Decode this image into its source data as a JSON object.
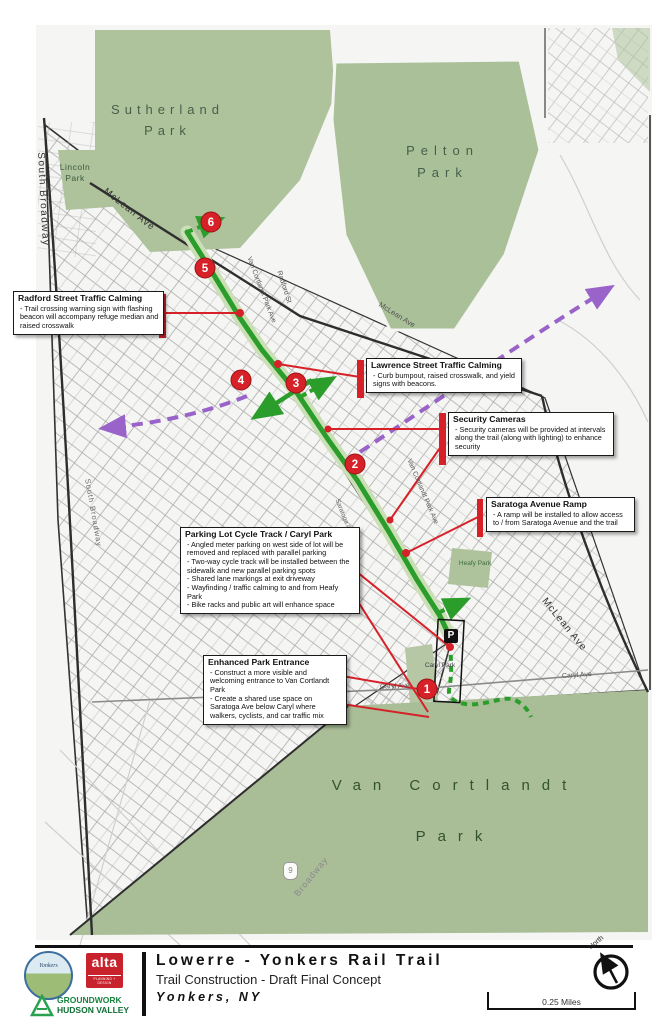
{
  "map": {
    "parks": [
      {
        "label": "Sutherland Park"
      },
      {
        "label": "Pelton Park"
      },
      {
        "label": "Lincoln Park"
      },
      {
        "label": "Van Cortlandt Park"
      },
      {
        "label": "Heafy Park"
      },
      {
        "label": "Caryl Park"
      }
    ],
    "streets": [
      {
        "label": "South Broadway"
      },
      {
        "label": "South Broadway"
      },
      {
        "label": "McLean Ave"
      },
      {
        "label": "McLean Ave"
      },
      {
        "label": "McLean Ave"
      },
      {
        "label": "Radford St"
      },
      {
        "label": "Radford St"
      },
      {
        "label": "Van Cortlandt Park Ave"
      },
      {
        "label": "Van Cortlandt Park Ave"
      },
      {
        "label": "Saratoga Ave"
      },
      {
        "label": "Caryl Ave"
      },
      {
        "label": "Caryl Ave"
      },
      {
        "label": "Broadway"
      }
    ],
    "route_shield": "9",
    "parking_label": "P",
    "markers": [
      {
        "n": "1"
      },
      {
        "n": "2"
      },
      {
        "n": "3"
      },
      {
        "n": "4"
      },
      {
        "n": "5"
      },
      {
        "n": "6"
      }
    ],
    "callouts": [
      {
        "title": "Radford Street Traffic Calming",
        "body": [
          "- Trail crossing warning sign with flashing beacon will accompany refuge median and raised crosswalk"
        ]
      },
      {
        "title": "Lawrence Street Traffic Calming",
        "body": [
          "- Curb bumpout, raised crosswalk, and yield signs with beacons."
        ]
      },
      {
        "title": "Security Cameras",
        "body": [
          "- Security cameras will be provided at intervals along the trail (along with lighting) to enhance security"
        ]
      },
      {
        "title": "Saratoga Avenue Ramp",
        "body": [
          "- A ramp will be installed to allow access to / from Saratoga Avenue and the trail"
        ]
      },
      {
        "title": "Parking Lot Cycle Track / Caryl Park",
        "body": [
          "- Angled meter parking on west side of lot will be removed and replaced with parallel parking",
          "- Two-way cycle track will be installed between the sidewalk and new parallel parking spots",
          "- Shared lane markings at exit driveway",
          "- Wayfinding / traffic calming to and from Heafy Park",
          "- Bike racks and public art will enhance space"
        ]
      },
      {
        "title": "Enhanced Park Entrance",
        "body": [
          "- Construct a more visible and welcoming entrance to Van Cortlandt Park",
          "- Create a shared use space on Saratoga Ave below Caryl where walkers, cyclists, and car traffic mix"
        ]
      }
    ]
  },
  "footer": {
    "title": "Lowerre - Yonkers Rail Trail",
    "subtitle": "Trail Construction - Draft Final Concept",
    "location": "Yonkers, NY",
    "scale_label": "0.25 Miles",
    "north_label": "North",
    "logos": {
      "yonkers": "Yonkers",
      "alta": "alta",
      "alta_sub": "PLANNING + DESIGN",
      "groundwork_line1": "GROUNDWORK",
      "groundwork_line2": "HUDSON VALLEY"
    }
  },
  "colors": {
    "park_green": "#aec29c",
    "vc_park_green": "#a9bd97",
    "trail_green": "#2b9d2b",
    "purple_route": "#9a63c9",
    "marker_red": "#d62128",
    "alta_red": "#c8232c",
    "groundwork_green": "#17843f"
  }
}
